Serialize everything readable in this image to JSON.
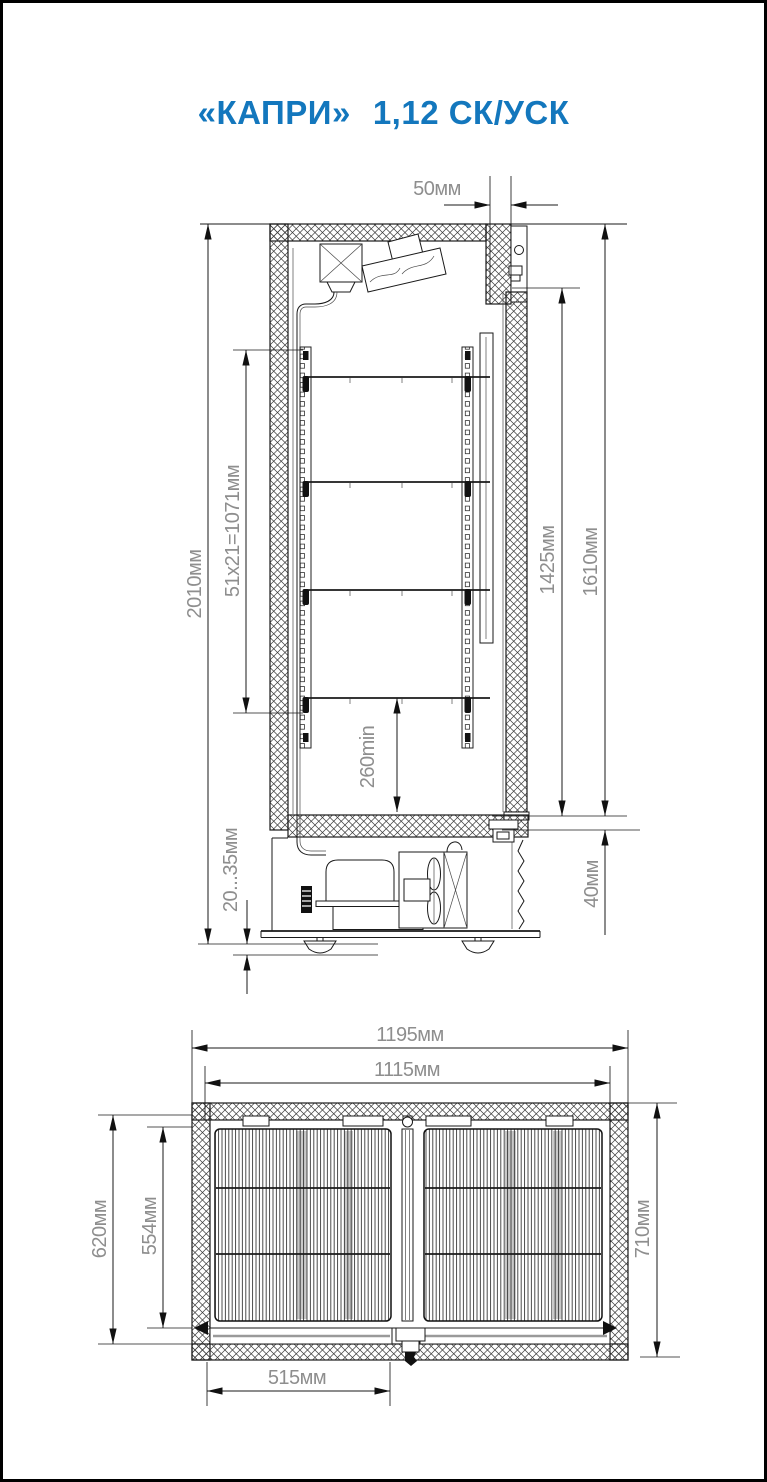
{
  "window": {
    "background": "#ffffff",
    "frame_color": "#000000"
  },
  "title": {
    "model": "«КАПРИ»",
    "variant": "1,12 СК/УСК",
    "color": "#1377bd"
  },
  "side_view": {
    "dims": {
      "top_frame_depth": "50мм",
      "overall_height": "2010мм",
      "rail_pitch": "51x21=1071мм",
      "glass_height": "1425мм",
      "door_height": "1610мм",
      "lowest_shelf_clearance": "260min",
      "feet_adjust_range": "20...35мм",
      "base_gap": "40мм"
    }
  },
  "top_view": {
    "dims": {
      "overall_width": "1195мм",
      "inner_width": "1115мм",
      "left_depth": "620мм",
      "shelf_depth": "554мм",
      "overall_depth": "710мм",
      "door_leaf_width": "515мм"
    }
  }
}
